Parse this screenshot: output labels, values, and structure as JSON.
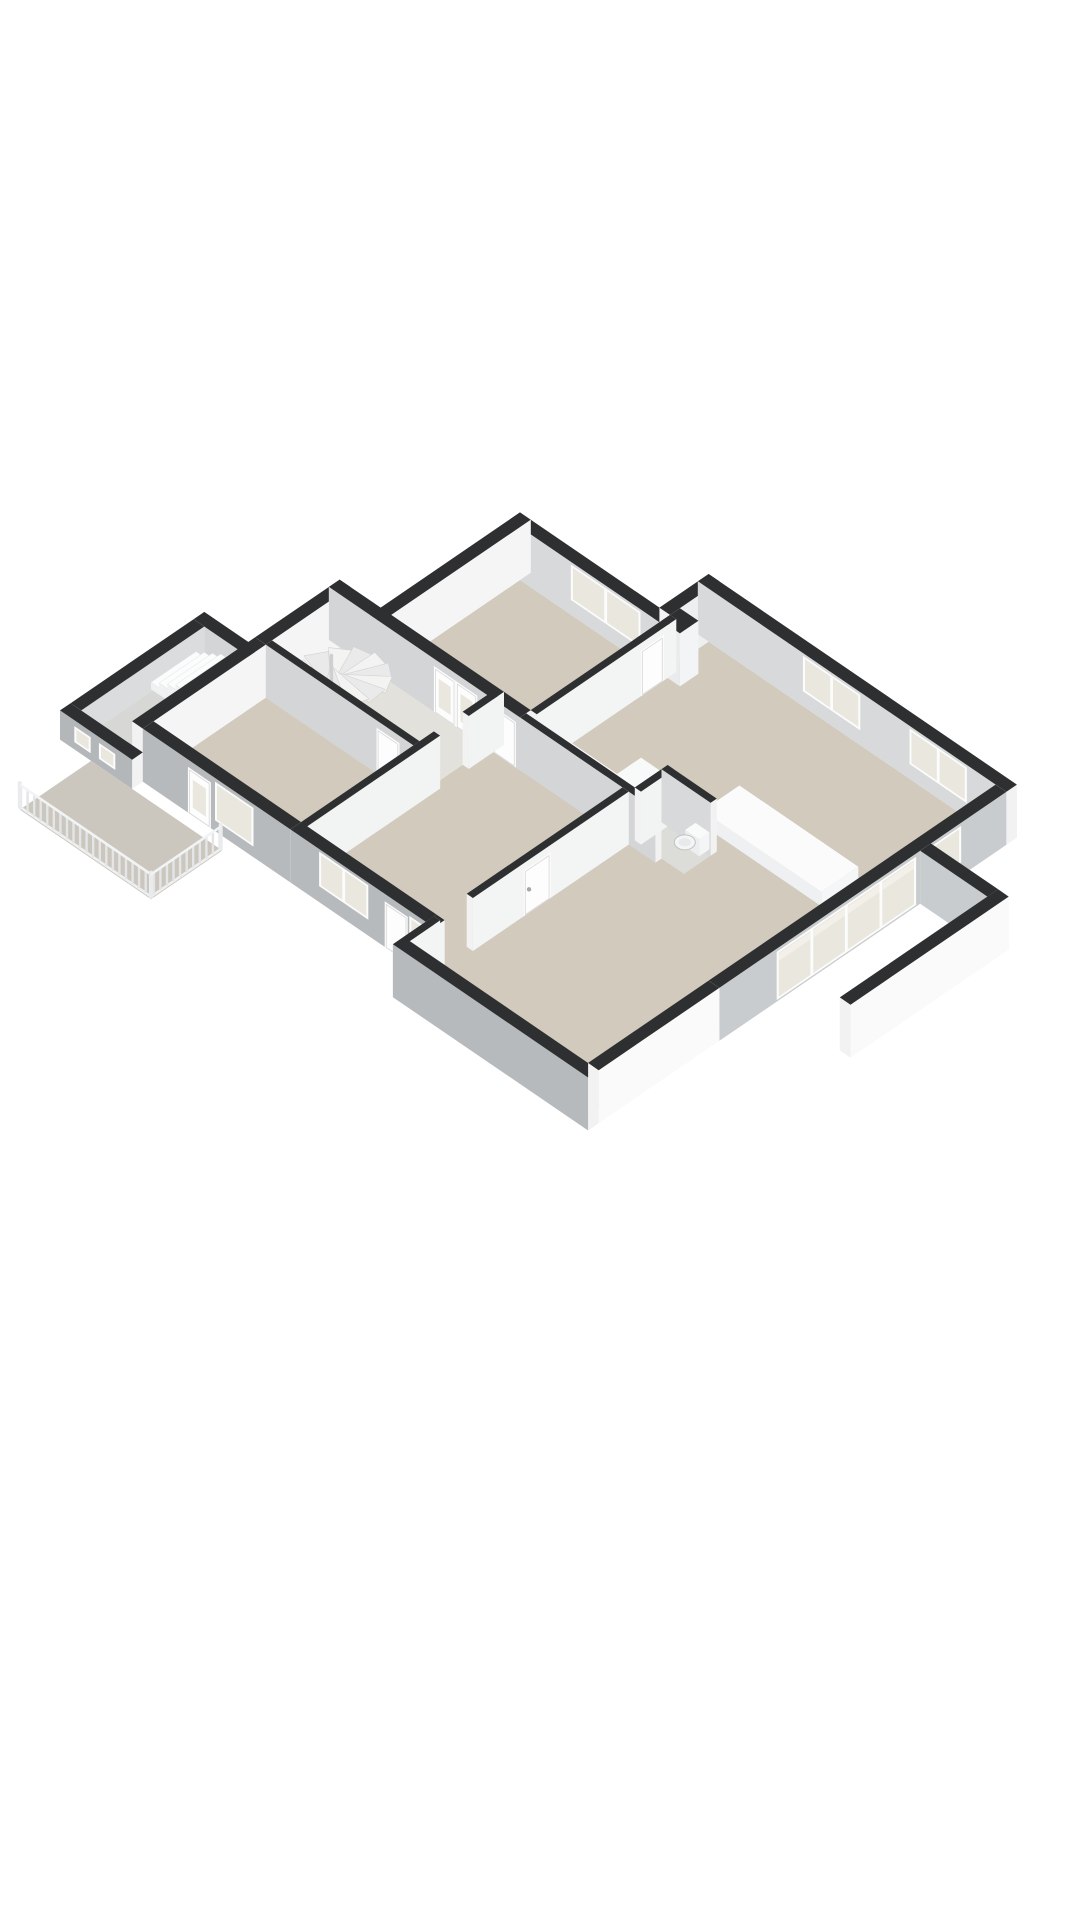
{
  "meta": {
    "kind": "3d-floorplan-render",
    "background": "#ffffff",
    "view": "isometric-cutaway",
    "visible_text": []
  },
  "palette": {
    "wall_cap": "#2d2f30",
    "wall_interior_light": "#f5f5f6",
    "wall_interior_mid": "#d7d9da",
    "wall_exterior_shade": "#b7babc",
    "wall_exterior_bright": "#fafafa",
    "floor_beige": "#d2cabc",
    "floor_hall": "#e3e1db",
    "floor_gray": "#cbc7be",
    "glass": "#e9e7de",
    "frame_white": "#fcfcfc"
  },
  "rooms": [
    "bedroom",
    "kitchen",
    "living-room",
    "hallway",
    "second-bedroom",
    "toilet",
    "corridor",
    "balcony",
    "entry-porch",
    "side-terrace"
  ],
  "scene": {
    "projection": {
      "x0": 520,
      "y0": 580,
      "kx": 41,
      "ky": 28,
      "kz": 53
    },
    "defaults": {
      "cap": "#2d2f30",
      "end": "#f2f2f2",
      "frame": "#fcfcfc",
      "glass": "#e9e7de",
      "panel": "#fdfdfe",
      "panel_stroke": "#d8d8d8",
      "curtain": "#f2f0e8",
      "handle": "#a4a6a8"
    },
    "items": [
      {
        "t": "floor",
        "name": "bedroom-floor",
        "pts": [
          [
            0,
            0
          ],
          [
            3.4,
            0
          ],
          [
            3.4,
            3.4
          ],
          [
            0,
            3.4
          ]
        ],
        "fill": "#d2cabc"
      },
      {
        "t": "floor",
        "name": "kitchen-living-corridor-floor",
        "pts": [
          [
            3.4,
            -1.2
          ],
          [
            10.4,
            -1.2
          ],
          [
            10.4,
            8.74
          ],
          [
            5.9,
            8.74
          ],
          [
            5.9,
            8.2
          ],
          [
            2.6,
            8.2
          ],
          [
            2.6,
            3.4
          ],
          [
            3.4,
            3.4
          ]
        ],
        "fill": "#d2cabc"
      },
      {
        "t": "floor",
        "name": "hallway-floor",
        "pts": [
          [
            -1,
            3.4
          ],
          [
            2.6,
            3.4
          ],
          [
            2.6,
            5.2
          ],
          [
            -1,
            5.2
          ]
        ],
        "fill": "#e3e1db"
      },
      {
        "t": "floor",
        "name": "second-bedroom-floor",
        "pts": [
          [
            -1,
            5.2
          ],
          [
            2.6,
            5.2
          ],
          [
            2.6,
            8.2
          ],
          [
            -1,
            8.2
          ]
        ],
        "fill": "#d2cabc"
      },
      {
        "t": "floor",
        "name": "toilet-floor",
        "pts": [
          [
            6.2,
            2.6
          ],
          [
            7.25,
            2.6
          ],
          [
            7.25,
            3.25
          ],
          [
            6.2,
            3.25
          ]
        ],
        "fill": "#dcdcd8"
      },
      {
        "t": "floor",
        "name": "porch-floor",
        "pts": [
          [
            -2.76,
            5.2
          ],
          [
            -1.26,
            5.2
          ],
          [
            -1.26,
            8.2
          ],
          [
            -2.76,
            8.2
          ]
        ],
        "fill": "#d7d7d5"
      },
      {
        "t": "floor",
        "name": "balcony-floor",
        "pts": [
          [
            -2,
            8.46
          ],
          [
            1.2,
            8.46
          ],
          [
            1.2,
            10.2
          ],
          [
            -2,
            10.2
          ]
        ],
        "fill": "#cbc7be"
      },
      {
        "t": "wall",
        "name": "bedroom-ne-wall",
        "a": [
          -0.26,
          -0.26
        ],
        "b": [
          3.4,
          -0.26
        ],
        "th": 0.26,
        "h": 1,
        "face": "#d7d9da",
        "windows": [
          {
            "d0": 1.5,
            "d1": 3.2,
            "z0": 0.28,
            "z1": 0.95,
            "panes": 2
          }
        ]
      },
      {
        "t": "wall",
        "name": "bedroom-nw-wall",
        "a": [
          -0.26,
          -0.26
        ],
        "b": [
          -0.26,
          3.4
        ],
        "th": 0.26,
        "h": 1,
        "face": "#f5f5f6"
      },
      {
        "t": "wall",
        "name": "kitchen-jog-wall",
        "a": [
          3.14,
          -1.46
        ],
        "b": [
          3.14,
          -0.26
        ],
        "th": 0.26,
        "h": 1,
        "face": "#eef0f0"
      },
      {
        "t": "wall",
        "name": "north-facade-wall",
        "a": [
          3.14,
          -1.46
        ],
        "b": [
          10.66,
          -1.46
        ],
        "th": 0.26,
        "h": 1,
        "face": "#d7d9da",
        "windows": [
          {
            "d0": 2.56,
            "d1": 3.96,
            "z0": 0.28,
            "z1": 0.95,
            "panes": 2
          },
          {
            "d0": 5.16,
            "d1": 6.56,
            "z0": 0.28,
            "z1": 0.95,
            "panes": 2
          }
        ]
      },
      {
        "t": "wall",
        "name": "hall-nw-wall",
        "a": [
          -1.26,
          3.14
        ],
        "b": [
          -1.26,
          5.2
        ],
        "th": 0.26,
        "h": 1,
        "face": "#f5f5f6"
      },
      {
        "t": "wall",
        "name": "hall-north-wall",
        "a": [
          -1.26,
          3.14
        ],
        "b": [
          3.4,
          3.14
        ],
        "th": 0.26,
        "h": 1,
        "face": "#d3d5d6",
        "doors": [
          {
            "d0": 2.56,
            "d1": 3.09,
            "glass": true
          },
          {
            "d0": 3.09,
            "d1": 3.62,
            "glass": true
          },
          {
            "d0": 4.0,
            "d1": 4.56
          }
        ]
      },
      {
        "t": "box",
        "name": "duct-shaft",
        "r": [
          3.4,
          -0.5,
          3.85,
          -0.05
        ],
        "h": 1,
        "top": "#2d2f30",
        "sw": "#e9ebec",
        "se": "#f3f4f5"
      },
      {
        "t": "wall",
        "name": "bedroom-se-wall",
        "a": [
          3.4,
          -0.26
        ],
        "b": [
          3.4,
          3.14
        ],
        "th": 0.15,
        "h": 1,
        "face": "#f3f4f4",
        "doors": [
          {
            "d0": 0.3,
            "d1": 0.86
          }
        ]
      },
      {
        "t": "spiral",
        "name": "spiral-staircase",
        "c": [
          -0.1,
          4.5
        ],
        "r": 1.05,
        "steps": 11,
        "a0": 150,
        "a1": 415
      },
      {
        "t": "wall",
        "name": "second-bedroom-nw-wall",
        "a": [
          -1.26,
          5.2
        ],
        "b": [
          -1.26,
          8.2
        ],
        "th": 0.26,
        "h": 1,
        "face": "#f5f5f6"
      },
      {
        "t": "wall",
        "name": "hall-bedroom-divider-wall",
        "a": [
          -1,
          5.05
        ],
        "b": [
          2.6,
          5.05
        ],
        "th": 0.15,
        "h": 1,
        "face": "#d3d5d6",
        "doors": [
          {
            "d0": 2.7,
            "d1": 3.26
          }
        ]
      },
      {
        "t": "wall",
        "name": "porch-north-low-wall",
        "a": [
          -2.76,
          4.94
        ],
        "b": [
          -1.26,
          4.94
        ],
        "th": 0.26,
        "h": 0.55,
        "face": "#d3d5d6"
      },
      {
        "t": "wall",
        "name": "porch-nw-low-wall",
        "a": [
          -2.76,
          5.2
        ],
        "b": [
          -2.76,
          8.2
        ],
        "th": 0.26,
        "h": 0.55,
        "face": "#dadcdd"
      },
      {
        "t": "stairs",
        "name": "entry-stairs",
        "u0": -2.55,
        "v0": 5.35,
        "v1": 6.45,
        "steps": 6,
        "tread": 0.2,
        "rise": 0.09
      },
      {
        "t": "wall",
        "name": "hall-east-wall-upper",
        "a": [
          2.6,
          3.14
        ],
        "b": [
          2.6,
          4.0
        ],
        "th": 0.15,
        "h": 1,
        "face": "#f2f3f3"
      },
      {
        "t": "wall",
        "name": "hall-east-wall-lower",
        "a": [
          2.6,
          4.7
        ],
        "b": [
          2.6,
          8.2
        ],
        "th": 0.15,
        "h": 1,
        "face": "#f2f3f3"
      },
      {
        "t": "box",
        "name": "kitchen-counter",
        "r": [
          3.7,
          2.6,
          5.5,
          3.23
        ],
        "h": 0.34,
        "top": "#fbfbfc",
        "sw": "#eef0f1",
        "se": "#f5f6f7"
      },
      {
        "t": "hob",
        "name": "kitchen-hob",
        "r": [
          4.0,
          2.68,
          4.85,
          3.16
        ],
        "z": 0.345,
        "k": 6.4
      },
      {
        "t": "box",
        "name": "kitchen-tall-cabinet",
        "r": [
          5.45,
          2.5,
          6.0,
          3.2
        ],
        "h": 0.85,
        "top": "#f8f9f9",
        "sw": "#e8eaeb",
        "se": "#f2f3f4",
        "k": 6.55
      },
      {
        "t": "wall",
        "name": "kitchen-south-wall",
        "a": [
          3.4,
          3.25
        ],
        "b": [
          6.7,
          3.25
        ],
        "th": 0.15,
        "h": 1,
        "face": "#d3d5d6",
        "k": 6.65
      },
      {
        "t": "wall",
        "name": "toilet-west-wall",
        "a": [
          6.05,
          2.45
        ],
        "b": [
          6.05,
          3.25
        ],
        "th": 0.15,
        "h": 1,
        "face": "#f2f3f3"
      },
      {
        "t": "wall",
        "name": "toilet-north-wall",
        "a": [
          6.05,
          2.45
        ],
        "b": [
          7.25,
          2.45
        ],
        "th": 0.15,
        "h": 1,
        "face": "#d7d9da"
      },
      {
        "t": "wc",
        "name": "toilet-fixture",
        "c": [
          6.95,
          2.95
        ],
        "k": 9.0
      },
      {
        "t": "box",
        "name": "kitchen-island",
        "r": [
          6.6,
          1.25,
          9.5,
          2.15
        ],
        "h": 0.27,
        "top": "#fbfbfc",
        "sw": "#eef0f1",
        "se": "#f5f6f7"
      },
      {
        "t": "wall",
        "name": "living-west-wall",
        "a": [
          5.9,
          3.4
        ],
        "b": [
          5.9,
          7.2
        ],
        "th": 0.15,
        "h": 1,
        "face": "#f3f4f4",
        "doors": [
          {
            "d0": 1.9,
            "d1": 2.56,
            "handle": true
          }
        ]
      },
      {
        "t": "wall",
        "name": "living-west-wall-south",
        "a": [
          5.9,
          8.0
        ],
        "b": [
          5.9,
          9.0
        ],
        "th": 0.15,
        "h": 1,
        "face": "#f3f4f4"
      },
      {
        "t": "wall",
        "name": "se-window-wall",
        "a": [
          10.4,
          -1.2
        ],
        "b": [
          10.4,
          5.8
        ],
        "th": 0.26,
        "h": 1,
        "face": "#c9ccce",
        "windows": [
          {
            "d0": 1.1,
            "d1": 1.9,
            "z0": 0.25,
            "z1": 0.94,
            "panes": 1
          },
          {
            "d0": 2.2,
            "d1": 5.6,
            "z0": 0.03,
            "z1": 0.94,
            "panes": 4,
            "curtain": true
          }
        ]
      },
      {
        "t": "wall",
        "name": "terrace-north-wall",
        "a": [
          10.66,
          0.64
        ],
        "b": [
          12.3,
          0.64
        ],
        "th": 0.26,
        "h": 1,
        "face": "#c9ccce"
      },
      {
        "t": "wall",
        "name": "terrace-east-wall",
        "a": [
          12.3,
          0.64
        ],
        "b": [
          12.3,
          4.5
        ],
        "th": 0.26,
        "h": 1,
        "face": "#fafafa"
      },
      {
        "t": "wall",
        "name": "se-lower-wall",
        "a": [
          10.4,
          5.8
        ],
        "b": [
          10.4,
          8.74
        ],
        "th": 0.26,
        "h": 1,
        "face": "#fafafa"
      },
      {
        "t": "wall",
        "name": "second-bedroom-front-wall",
        "a": [
          -1,
          7.94
        ],
        "b": [
          2.6,
          7.94
        ],
        "th": 0.26,
        "h": 1,
        "face": "#b7babc",
        "doors": [
          {
            "d0": 1.1,
            "d1": 1.66,
            "glass": true
          }
        ],
        "windows": [
          {
            "d0": 1.76,
            "d1": 2.7,
            "z0": 0.2,
            "z1": 0.93,
            "panes": 1
          }
        ]
      },
      {
        "t": "wall",
        "name": "porch-front-low-wall",
        "a": [
          -2.76,
          8.2
        ],
        "b": [
          -1,
          8.2
        ],
        "th": 0.26,
        "h": 0.55,
        "face": "#b4b7b9",
        "windows": [
          {
            "d0": 0.35,
            "d1": 0.75,
            "z0": 0.14,
            "z1": 0.44,
            "panes": 1
          },
          {
            "d0": 0.95,
            "d1": 1.35,
            "z0": 0.14,
            "z1": 0.44,
            "panes": 1
          }
        ]
      },
      {
        "t": "wall",
        "name": "corridor-front-wall",
        "a": [
          2.6,
          7.94
        ],
        "b": [
          5.9,
          7.94
        ],
        "th": 0.26,
        "h": 1,
        "face": "#b7babc",
        "windows": [
          {
            "d0": 0.7,
            "d1": 1.9,
            "z0": 0.3,
            "z1": 0.95,
            "panes": 2
          },
          {
            "d0": 2.9,
            "d1": 3.2,
            "z0": 0.25,
            "z1": 0.9,
            "panes": 1
          }
        ],
        "doors": [
          {
            "d0": 2.3,
            "d1": 2.86
          }
        ]
      },
      {
        "t": "wall",
        "name": "front-jog-wall",
        "a": [
          5.9,
          7.94
        ],
        "b": [
          5.9,
          8.74
        ],
        "th": 0.2,
        "h": 1,
        "face": "#f3f4f4"
      },
      {
        "t": "wall",
        "name": "living-front-wall",
        "a": [
          5.9,
          8.74
        ],
        "b": [
          10.66,
          8.74
        ],
        "th": 0.26,
        "h": 1,
        "face": "#b7babc"
      },
      {
        "t": "rail",
        "name": "balcony-railing-front",
        "a": [
          -2,
          10.2
        ],
        "b": [
          1.2,
          10.2
        ],
        "h": 0.5
      },
      {
        "t": "rail",
        "name": "balcony-railing-side",
        "a": [
          1.2,
          8.5
        ],
        "b": [
          1.2,
          10.2
        ],
        "h": 0.5
      }
    ]
  }
}
